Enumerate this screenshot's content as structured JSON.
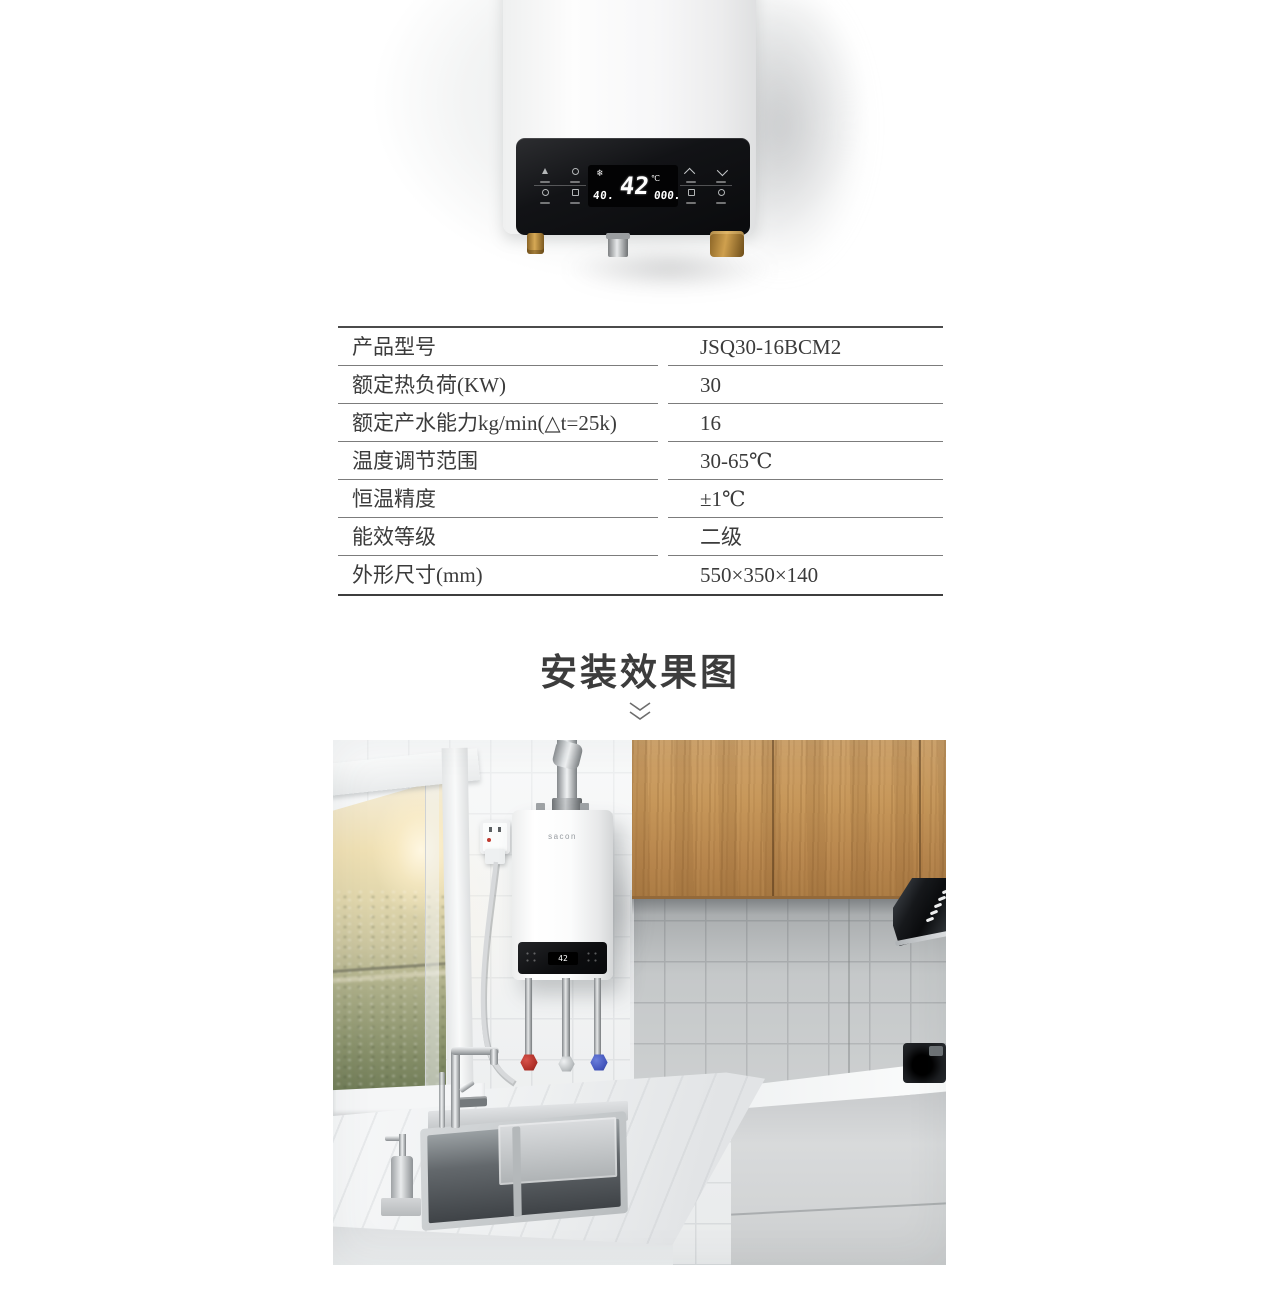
{
  "hero": {
    "display": {
      "left_value": "40.",
      "temp": "42",
      "temp_unit": "℃",
      "right_value": "000."
    },
    "icons": {
      "snowflake": "❄"
    }
  },
  "specs": {
    "rows": [
      {
        "label": "产品型号",
        "value": "JSQ30-16BCM2"
      },
      {
        "label": "额定热负荷(KW)",
        "value": "30"
      },
      {
        "label": "额定产水能力kg/min(△t=25k)",
        "value": "16"
      },
      {
        "label": "温度调节范围",
        "value": "30-65℃"
      },
      {
        "label": "恒温精度",
        "value": "±1℃"
      },
      {
        "label": "能效等级",
        "value": "二级"
      },
      {
        "label": "外形尺寸(mm)",
        "value": "550×350×140"
      }
    ]
  },
  "install_section": {
    "title": "安装效果图"
  },
  "kitchen": {
    "brand": "sacon",
    "display_temp": "42"
  },
  "colors": {
    "text": "#3b3b3b",
    "table_line": "#7c7c7c",
    "panel_black": "#121316",
    "wood": "#c49257",
    "valve_hot": "#c0392f",
    "valve_cold": "#4456bd",
    "brass": "#b9893f"
  }
}
